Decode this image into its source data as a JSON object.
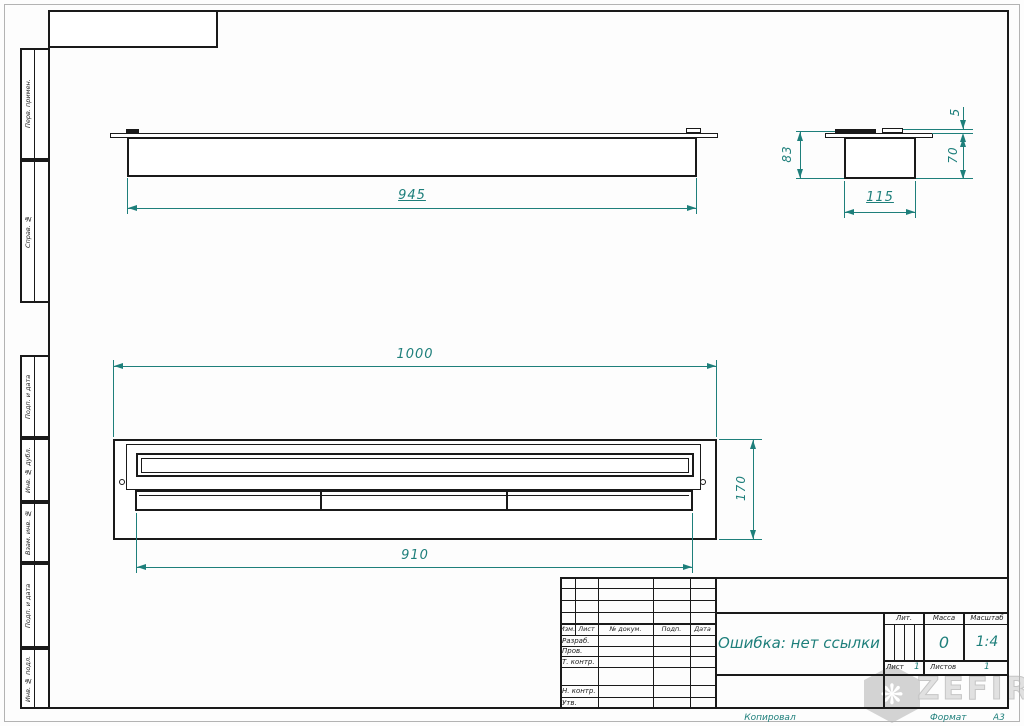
{
  "colors": {
    "dimension": "#1e7f7b",
    "line": "#1a1a1a"
  },
  "margin_stamps": [
    "Перв. примен.",
    "Справ. №",
    "Подп. и дата",
    "Инв. № дубл.",
    "Взам. инв. №",
    "Подп. и дата",
    "Инв. № подл."
  ],
  "views": {
    "front": {
      "width": "945"
    },
    "side": {
      "total_height": "83",
      "flange_height": "5",
      "body_height": "70",
      "width": "115"
    },
    "plan": {
      "overall_width": "1000",
      "depth": "170",
      "slot_width": "910"
    }
  },
  "title_block": {
    "revision_header": {
      "izm": "Изм.",
      "list": "Лист",
      "doc": "№ докум.",
      "podp": "Подп.",
      "data": "Дата"
    },
    "rows": {
      "razrab": "Разраб.",
      "prov": "Пров.",
      "tkontr": "Т. контр.",
      "nkontr": "Н. контр.",
      "utv": "Утв."
    },
    "document_name": "Ошибка: нет ссылки",
    "lit_label": "Лит.",
    "mass_label": "Масса",
    "scale_label": "Масштаб",
    "mass_value": "0",
    "scale_value": "1:4",
    "sheet_label": "Лист",
    "sheet_value": "1",
    "sheets_label": "Листов",
    "sheets_value": "1"
  },
  "footer": {
    "kopiroval": "Копировал",
    "format_label": "Формат",
    "format_value": "А3"
  },
  "watermark": {
    "brand": "ZEFIRE",
    "logo": "pinwheel"
  }
}
